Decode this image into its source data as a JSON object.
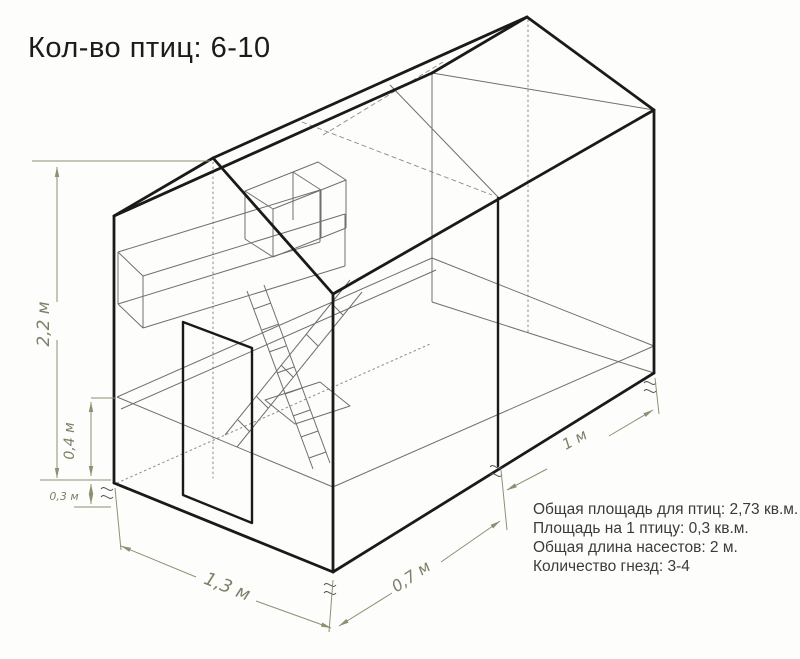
{
  "title": "Кол-во птиц: 6-10",
  "dimensions": {
    "total_height": "2,2 м",
    "interior_floor_height": "0,4 м",
    "ground_clearance": "0,3 м",
    "front_width": "1,3 м",
    "house_depth": "0,7 м",
    "run_depth": "1 м"
  },
  "info": {
    "lines": [
      "Общая площадь для птиц: 2,73 кв.м.",
      "Площадь на 1 птицу: 0,3 кв.м.",
      "Общая длина насестов: 2 м.",
      "Количество гнезд: 3-4"
    ]
  },
  "colors": {
    "outline": "#1a1a1a",
    "thin_line": "#6f6f6f",
    "hidden_line": "#949494",
    "dimension": "#8f8f73",
    "info_text": "#3b3b3b",
    "background": "#fdfdfb"
  }
}
